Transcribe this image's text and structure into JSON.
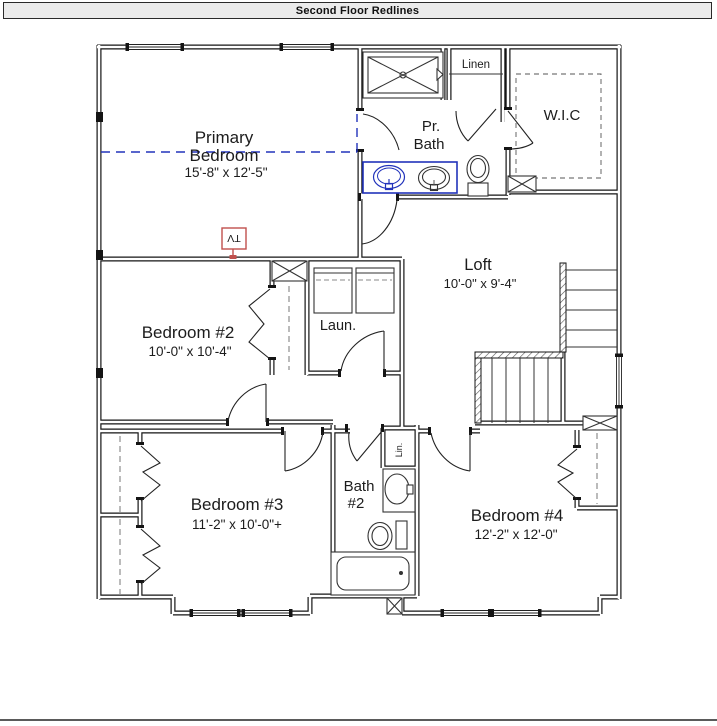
{
  "title_bar": {
    "title": "Second Floor Redlines"
  },
  "rooms": {
    "primary_bedroom": {
      "line1": "Primary",
      "line2": "Bedroom",
      "dims": "15'-8\" x 12'-5\""
    },
    "pr_bath": {
      "line1": "Pr.",
      "line2": "Bath"
    },
    "wic": {
      "label": "W.I.C"
    },
    "linen": {
      "label": "Linen"
    },
    "loft": {
      "label": "Loft",
      "dims": "10'-0\" x 9'-4\""
    },
    "bedroom2": {
      "label": "Bedroom #2",
      "dims": "10'-0\" x 10'-4\""
    },
    "laundry": {
      "label": "Laun."
    },
    "bedroom3": {
      "label": "Bedroom #3",
      "dims": "11'-2\" x 10'-0\"+"
    },
    "bath2": {
      "line1": "Bath",
      "line2": "#2"
    },
    "lin_closet": {
      "label": "Lin."
    },
    "bedroom4": {
      "label": "Bedroom #4",
      "dims": "12'-2\" x 12'-0\""
    }
  },
  "markup": {
    "tv_label": "TV",
    "redline_blue": "#2233bb",
    "markup_red": "#c0504d"
  }
}
